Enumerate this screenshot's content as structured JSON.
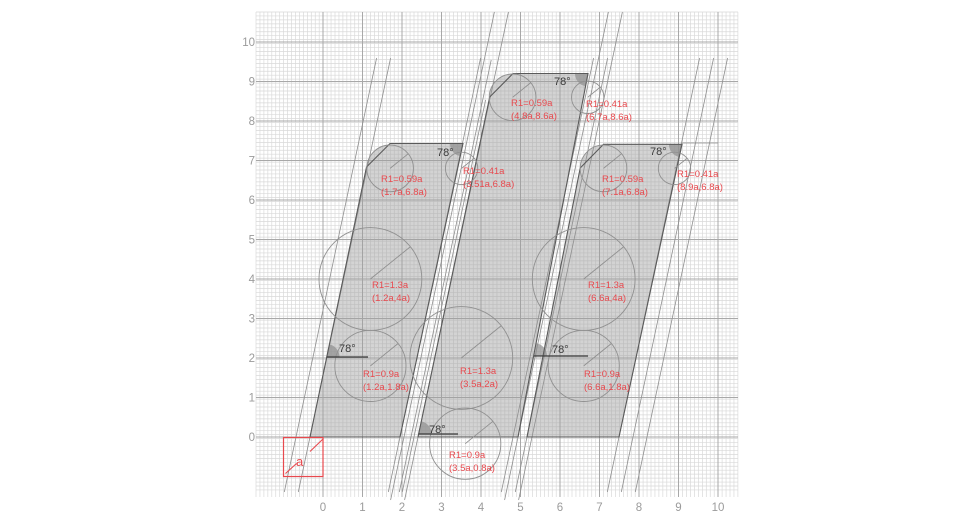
{
  "canvas": {
    "width": 980,
    "height": 532,
    "background": "#ffffff"
  },
  "colors": {
    "grid_minor": "#d9d9d9",
    "grid_major": "#a8a8a8",
    "band_fill": "#9f9f9f",
    "band_fill_opacity": 0.45,
    "band_edge": "#5a5a5a",
    "construction": "#8f8f8f",
    "circle_stroke": "#909090",
    "wedge_fill": "#8f8f8f",
    "annotation_text": "#3a3a3a",
    "axis_text": "#9b9b9b",
    "accent_red": "#e8494e"
  },
  "grid": {
    "origin_px": {
      "x": 323,
      "y": 437
    },
    "unit_px": 39.5,
    "minor_step_px": 3.95,
    "x_range_px": [
      256,
      738
    ],
    "y_range_px": [
      12,
      490
    ],
    "vline_y_extent": [
      12,
      497
    ],
    "major_units": [
      0,
      1,
      2,
      3,
      4,
      5,
      6,
      7,
      8,
      9,
      10
    ]
  },
  "axes": {
    "x_ticks": [
      "0",
      "1",
      "2",
      "3",
      "4",
      "5",
      "6",
      "7",
      "8",
      "9",
      "10"
    ],
    "y_ticks": [
      "0",
      "1",
      "2",
      "3",
      "4",
      "5",
      "6",
      "7",
      "8",
      "9",
      "10"
    ],
    "x_label_baseline_y": 511,
    "y_label_right_x": 255
  },
  "unit_square": {
    "label": "a",
    "rect_px": [
      283.5,
      437.5,
      323,
      476.5
    ],
    "diag_segments": [
      [
        285.5,
        473.5,
        296.5,
        463.5
      ],
      [
        310,
        451.5,
        323.5,
        438.5
      ]
    ],
    "label_px": [
      296,
      466
    ]
  },
  "bands": [
    {
      "name": "left-stem",
      "polygon": [
        [
          310,
          437
        ],
        [
          366.5,
          167
        ],
        [
          390,
          143.5
        ],
        [
          463,
          143.5
        ],
        [
          400,
          437
        ]
      ],
      "corner_circle": [
        390.2,
        167.5,
        23.3
      ]
    },
    {
      "name": "middle-stem",
      "polygon": [
        [
          418,
          437
        ],
        [
          489.7,
          97
        ],
        [
          513,
          73.5
        ],
        [
          588,
          73.5
        ],
        [
          518,
          437
        ]
      ],
      "corner_circle": [
        512.6,
        97.3,
        23.3
      ]
    },
    {
      "name": "right-stem",
      "polygon": [
        [
          527,
          437
        ],
        [
          580.2,
          168
        ],
        [
          603.5,
          144.3
        ],
        [
          682,
          144.3
        ],
        [
          619,
          437
        ]
      ],
      "corner_circle": [
        603.5,
        168.2,
        23.3
      ]
    }
  ],
  "construction_lines": [
    {
      "x_base": 296,
      "y_top": 58,
      "y_bot": 492
    },
    {
      "x_base": 310,
      "y_top": 58,
      "y_bot": 492
    },
    {
      "x_base": 400,
      "y_top": 58,
      "y_bot": 492
    },
    {
      "x_base": 414,
      "y_top": 100,
      "y_bot": 492
    },
    {
      "x_base": 404,
      "y_top": 12,
      "y_bot": 500
    },
    {
      "x_base": 411,
      "y_top": 60,
      "y_bot": 492
    },
    {
      "x_base": 418,
      "y_top": 12,
      "y_bot": 500
    },
    {
      "x_base": 518,
      "y_top": 12,
      "y_bot": 500
    },
    {
      "x_base": 532,
      "y_top": 12,
      "y_bot": 500
    },
    {
      "x_base": 513,
      "y_top": 58,
      "y_bot": 492
    },
    {
      "x_base": 527,
      "y_top": 58,
      "y_bot": 492
    },
    {
      "x_base": 619,
      "y_top": 58,
      "y_bot": 492
    },
    {
      "x_base": 633,
      "y_top": 58,
      "y_bot": 492
    },
    {
      "x_base": 647,
      "y_top": 58,
      "y_bot": 492
    }
  ],
  "misc_segments": [
    [
      682,
      143,
      718,
      143
    ]
  ],
  "circles": [
    {
      "cx": 1.2,
      "cy": 1.8,
      "r": 0.9,
      "label": [
        "R1=0.9a",
        "(1.2a,1.8a)"
      ],
      "label_px": [
        363,
        377
      ]
    },
    {
      "cx": 1.2,
      "cy": 4.0,
      "r": 1.3,
      "label": [
        "R1=1.3a",
        "(1.2a,4a)"
      ],
      "label_px": [
        372,
        288
      ]
    },
    {
      "cx": 1.7,
      "cy": 6.8,
      "r": 0.59,
      "label": [
        "R1=0.59a",
        "(1.7a,6.8a)"
      ],
      "label_px": [
        381,
        182
      ]
    },
    {
      "cx": 3.51,
      "cy": 6.8,
      "r": 0.41,
      "label": [
        "R1=0.41a",
        "(3.51a,6.8a)"
      ],
      "label_px": [
        463,
        174
      ]
    },
    {
      "cx": 3.5,
      "cy": 2.0,
      "r": 1.3,
      "label": [
        "R1=1.3a",
        "(3.5a,2a)"
      ],
      "label_px": [
        460,
        374
      ]
    },
    {
      "cx": 3.5,
      "cy": 0.8,
      "r": 0.9,
      "label": [
        "R1=0.9a",
        "(3.5a,0.8a)"
      ],
      "label_px": [
        449,
        458
      ],
      "draw_px": [
        465.2,
        443.7
      ]
    },
    {
      "cx": 4.8,
      "cy": 8.6,
      "r": 0.59,
      "label": [
        "R1=0.59a",
        "(4.8a,8.6a)"
      ],
      "label_px": [
        511,
        106
      ]
    },
    {
      "cx": 6.7,
      "cy": 8.6,
      "r": 0.41,
      "label": [
        "R1=0.41a",
        "(6.7a,8.6a)"
      ],
      "label_px": [
        586,
        107
      ]
    },
    {
      "cx": 6.6,
      "cy": 4.0,
      "r": 1.3,
      "label": [
        "R1=1.3a",
        "(6.6a,4a)"
      ],
      "label_px": [
        588,
        288
      ]
    },
    {
      "cx": 6.6,
      "cy": 1.8,
      "r": 0.9,
      "label": [
        "R1=0.9a",
        "(6.6a,1.8a)"
      ],
      "label_px": [
        584,
        377
      ]
    },
    {
      "cx": 7.1,
      "cy": 6.8,
      "r": 0.59,
      "label": [
        "R1=0.59a",
        "(7.1a,6.8a)"
      ],
      "label_px": [
        602,
        182
      ]
    },
    {
      "cx": 8.9,
      "cy": 6.8,
      "r": 0.41,
      "label": [
        "R1=0.41a",
        "(8.9a,6.8a)"
      ],
      "label_px": [
        677,
        177
      ]
    }
  ],
  "angle_annotations": [
    {
      "label": "78°",
      "vx": 463,
      "vy": 143.5,
      "type": "down",
      "label_px": [
        437,
        156
      ],
      "hline_to": null
    },
    {
      "label": "78°",
      "vx": 588,
      "vy": 73.5,
      "type": "down",
      "label_px": [
        554,
        85
      ],
      "hline_to": null
    },
    {
      "label": "78°",
      "vx": 682,
      "vy": 144.3,
      "type": "down",
      "label_px": [
        650,
        155
      ],
      "hline_to": null
    },
    {
      "label": "78°",
      "vx": 326.5,
      "vy": 357,
      "type": "up",
      "label_px": [
        339,
        352
      ],
      "hline_to": 368
    },
    {
      "label": "78°",
      "vx": 534,
      "vy": 356,
      "type": "up",
      "label_px": [
        552,
        353
      ],
      "hline_to": 588
    },
    {
      "label": "78°",
      "vx": 418.6,
      "vy": 434,
      "type": "up",
      "label_px": [
        429,
        433
      ],
      "hline_to": 458
    }
  ],
  "slant": {
    "angle_deg": 78,
    "dx_per_dy": 0.2126
  }
}
